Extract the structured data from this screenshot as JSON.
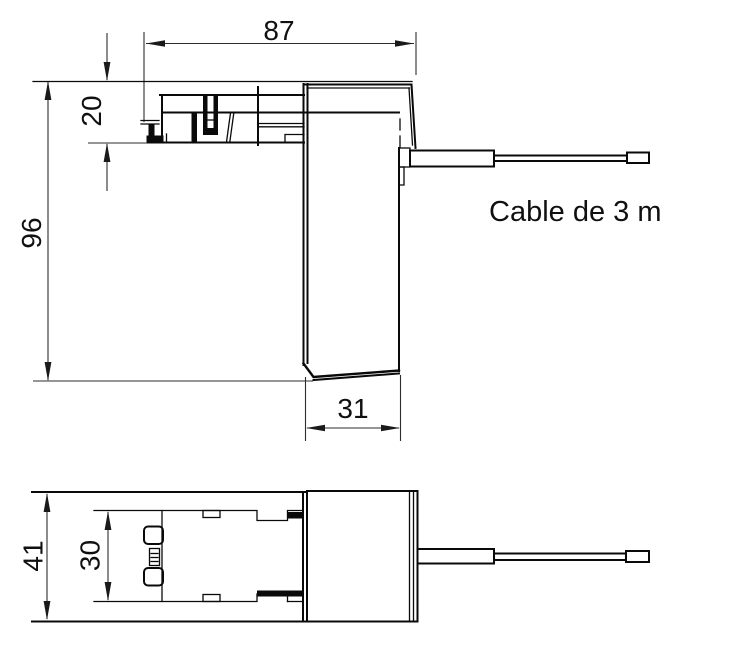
{
  "drawing": {
    "dimensions": {
      "overall_width": "87",
      "clip_height": "20",
      "overall_height": "96",
      "body_width": "31",
      "overall_depth": "41",
      "inner_depth": "30"
    },
    "labels": {
      "cable": "Cable de 3 m"
    },
    "colors": {
      "object_line": "#0a0a0a",
      "dimension_line": "#2d2d2d",
      "text": "#101010",
      "background": "#ffffff"
    }
  }
}
